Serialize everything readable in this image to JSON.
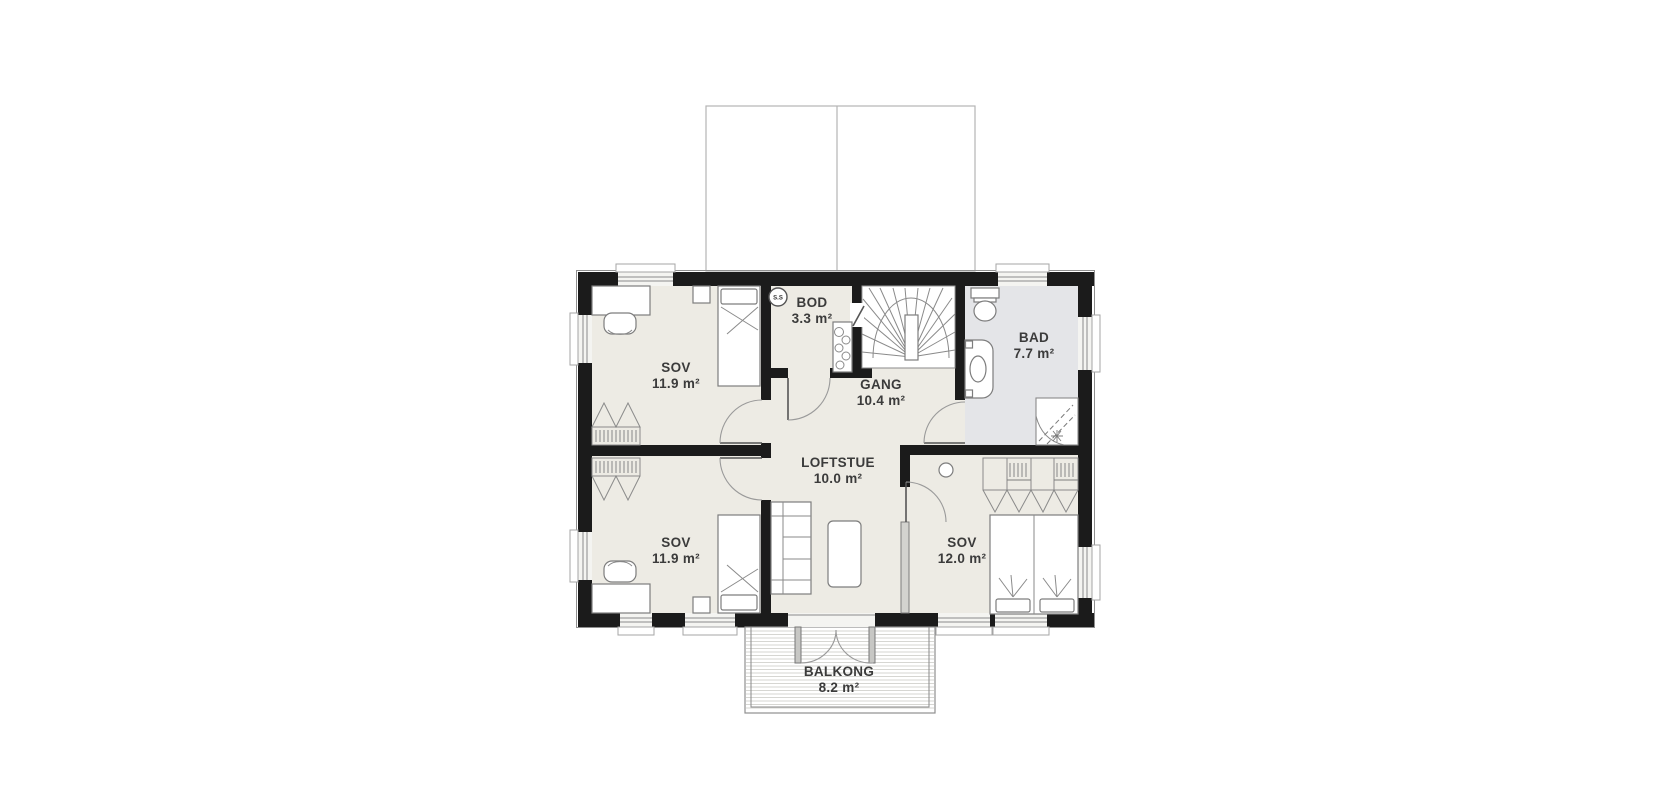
{
  "plan": {
    "type": "floor-plan",
    "unit": "m²",
    "rooms": [
      {
        "id": "sov-upper-left",
        "name": "SOV",
        "area": "11.9 m²"
      },
      {
        "id": "bod",
        "name": "BOD",
        "area": "3.3 m²"
      },
      {
        "id": "gang",
        "name": "GANG",
        "area": "10.4 m²"
      },
      {
        "id": "bad",
        "name": "BAD",
        "area": "7.7 m²"
      },
      {
        "id": "sov-lower-left",
        "name": "SOV",
        "area": "11.9 m²"
      },
      {
        "id": "loftstue",
        "name": "LOFTSTUE",
        "area": "10.0 m²"
      },
      {
        "id": "sov-right",
        "name": "SOV",
        "area": "12.0 m²"
      },
      {
        "id": "balkong",
        "name": "BALKONG",
        "area": "8.2 m²"
      }
    ],
    "symbols": {
      "smoke_detector": "S.S"
    },
    "colors": {
      "wall": "#1b1b1b",
      "floor": "#edebe4",
      "bathroom_floor": "#e4e5e8",
      "furniture_line": "#7d7d7d",
      "text": "#3b3b3b"
    }
  }
}
